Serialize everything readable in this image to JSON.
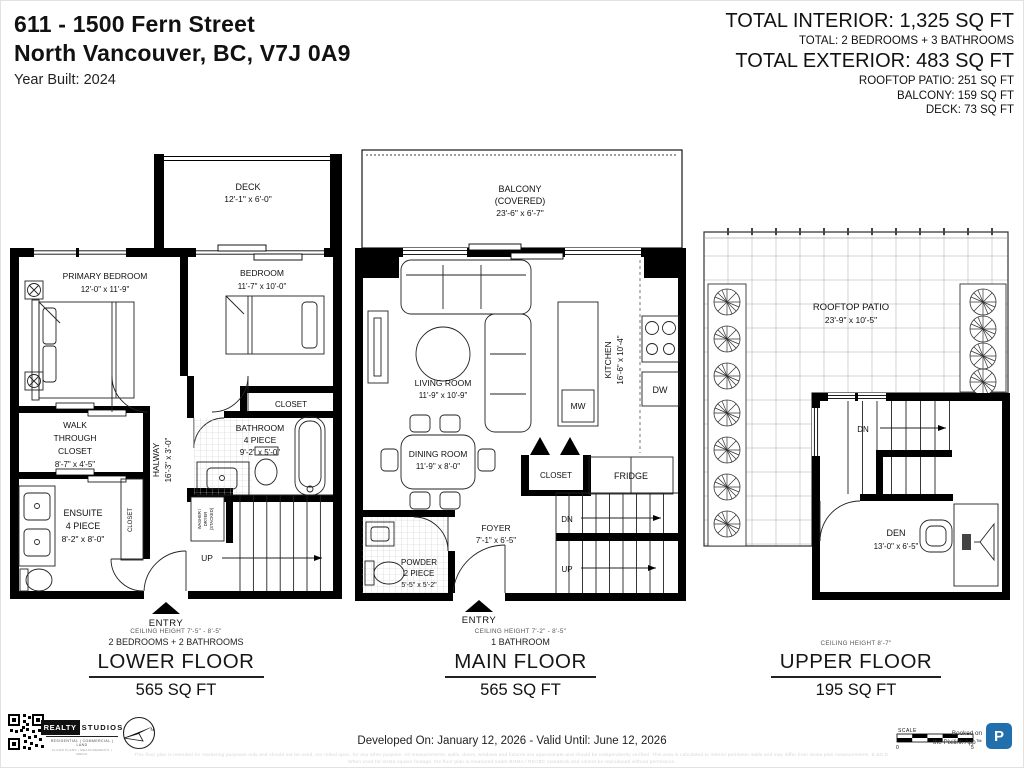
{
  "page": {
    "accent_blue": "#2170ad"
  },
  "header": {
    "address_line1": "611 - 1500 Fern Street",
    "address_line2": "North Vancouver, BC, V7J 0A9",
    "year_built": "Year Built: 2024",
    "total_interior": "TOTAL INTERIOR: 1,325 SQ FT",
    "total_rooms": "TOTAL: 2 BEDROOMS + 3 BATHROOMS",
    "total_exterior": "TOTAL EXTERIOR: 483 SQ FT",
    "rooftop_patio": "ROOFTOP PATIO: 251 SQ FT",
    "balcony": "BALCONY: 159 SQ FT",
    "deck": "DECK: 73 SQ FT"
  },
  "lower": {
    "deck": "DECK",
    "deck_d": "12'-1\" x 6'-0\"",
    "primary": "PRIMARY BEDROOM",
    "primary_d": "12'-0\" x 11'-9\"",
    "bedroom": "BEDROOM",
    "bedroom_d": "11'-7\" x 10'-0\"",
    "closet": "CLOSET",
    "wtc1": "WALK",
    "wtc2": "THROUGH",
    "wtc3": "CLOSET",
    "wtc_d": "8'-7\" x 4'-5\"",
    "hall": "HALWAY",
    "hall_d": "16'-3\" x 3'-0\"",
    "bath1": "BATHROOM",
    "bath2": "4 PIECE",
    "bath_d": "9'-2\" x 5'-0\"",
    "closet_v": "CLOSET",
    "ens1": "ENSUITE",
    "ens2": "4 PIECE",
    "ens_d": "8'-2\" x 8'-0\"",
    "wd1": "WASHER /",
    "wd2": "DRYER",
    "wd3": "(STACKED)",
    "up": "UP",
    "entry": "ENTRY",
    "ceiling": "CEILING HEIGHT 7'-5\" - 8'-5\"",
    "rooms": "2 BEDROOMS + 2 BATHROOMS",
    "name": "LOWER FLOOR",
    "area": "565 SQ FT"
  },
  "main": {
    "balc1": "BALCONY",
    "balc2": "(COVERED)",
    "balc_d": "23'-6\" x 6'-7\"",
    "living": "LIVING ROOM",
    "living_d": "11'-9\" x 10'-9\"",
    "kitchen": "KITCHEN",
    "kitchen_d": "16'-6\" x 10'-4\"",
    "mw": "MW",
    "dw": "DW",
    "fridge": "FRIDGE",
    "closet": "CLOSET",
    "dining": "DINING ROOM",
    "dining_d": "11'-9\" x 8'-0\"",
    "foyer": "FOYER",
    "foyer_d": "7'-1\" x 6'-5\"",
    "pow1": "POWDER",
    "pow2": "2 PIECE",
    "pow_d": "5'-5\" x 5'-2\"",
    "dn": "DN",
    "up": "UP",
    "entry": "ENTRY",
    "ceiling": "CEILING HEIGHT 7'-2\" - 8'-5\"",
    "rooms": "1 BATHROOM",
    "name": "MAIN FLOOR",
    "area": "565 SQ FT"
  },
  "upper": {
    "patio": "ROOFTOP PATIO",
    "patio_d": "23'-9\" x 10'-5\"",
    "dn": "DN",
    "den": "DEN",
    "den_d": "13'-0\" x 6'-5\"",
    "ceiling": "CEILING HEIGHT 8'-7\"",
    "name": "UPPER FLOOR",
    "area": "195 SQ FT"
  },
  "footer": {
    "logo_realty": "REALTY",
    "logo_studios": "STUDIOS",
    "logo_tag1": "RESIDENTIAL | COMMERCIAL | LAND",
    "logo_tag2": "FLOOR PLANS | MEASUREMENTS | MEDIA",
    "compass_n": "N",
    "developed": "Developed On: January 12, 2026 - Valid Until: June 12, 2026",
    "scale_label": "SCALE",
    "scale_start": "0",
    "scale_end": "5",
    "booked_l1": "Booked on",
    "booked_l2": "the Pixilink App™",
    "badge_letter": "P",
    "disclaimer_l1": "This floor plan is intended for marketing purposes only and should not be used, nor relied upon, for any other purpose. All measurements, walls, doors, windows and fixtures are approximate and should be independently verified. This area is calculated to interior perimeter walls and may differ from strata plan measurements. E.&O.E.",
    "disclaimer_l2": "When used for strata square footage, the floor plan is measured under BOMA / RECBC standards and cannot be reproduced without permission."
  }
}
